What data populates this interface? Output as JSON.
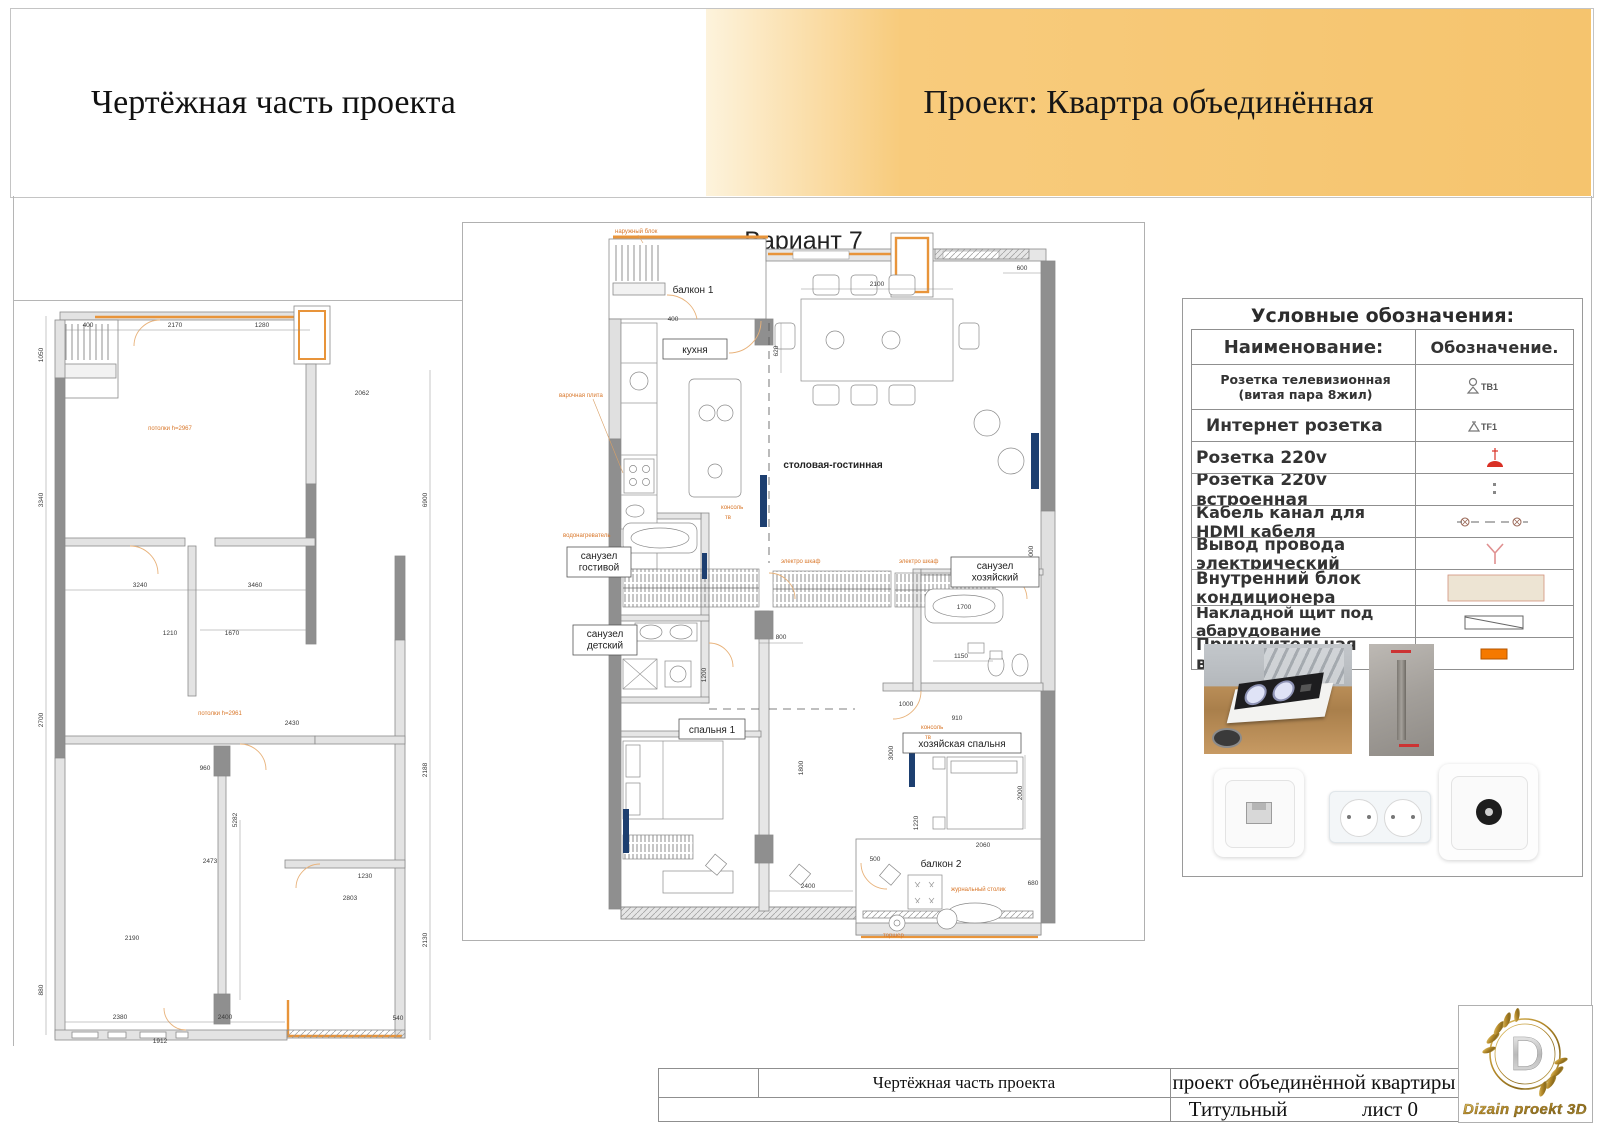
{
  "header": {
    "left_title": "Чертёжная часть проекта",
    "right_title": "Проект: Квартра объединённая"
  },
  "center_plan": {
    "title": "Вариант 7",
    "rooms": {
      "balcony1": "балкон 1",
      "kitchen": "кухня",
      "living": "столовая-гостинная",
      "bath_guest": "санузел\nгостивой",
      "bath_kids": "санузел\nдетский",
      "bath_master": "санузел\nхозяйский",
      "bedroom1": "спальня 1",
      "bedroom_master": "хозяйская спальня",
      "balcony2": "балкон 2"
    },
    "annotations": [
      "наружный блок",
      "варочная плита",
      "водонагреватель",
      "электро шкаф",
      "электро шкаф",
      "консоль",
      "тв",
      "консоль",
      "тв",
      "журнальный столик",
      "торшер"
    ],
    "dims": [
      "2100",
      "600",
      "620",
      "800",
      "400",
      "1200",
      "1000",
      "1020",
      "2400",
      "910",
      "2000",
      "1150",
      "1700",
      "5000",
      "3000",
      "1800",
      "500",
      "1220",
      "2060",
      "680"
    ]
  },
  "left_plan": {
    "ceiling_top": "потолки h=2967",
    "ceiling_bottom": "потолки h=2961",
    "dims": [
      "1050",
      "2170",
      "400",
      "1280",
      "3340",
      "2700",
      "1210",
      "1670",
      "2430",
      "2062",
      "3240",
      "3460",
      "6900",
      "2188",
      "2130",
      "2380",
      "2400",
      "1912",
      "880",
      "1230",
      "2473",
      "2803",
      "5282",
      "960",
      "2190",
      "540"
    ]
  },
  "legend": {
    "title": "Условные обозначения:",
    "col_name": "Наименование:",
    "col_symbol": "Обозначение.",
    "rows": [
      {
        "name": "Розетка телевизионная\n(витая пара 8жил)",
        "tag": "ТВ1"
      },
      {
        "name": "Интернет розетка",
        "tag": "TF1"
      },
      {
        "name": "Розетка 220v"
      },
      {
        "name": "Розетка 220v встроенная"
      },
      {
        "name": "Кабель канал для HDMI кабеля"
      },
      {
        "name": "Вывод провода электрический"
      },
      {
        "name": "Внутренний блок кондиционера"
      },
      {
        "name": "Накладной щит под абарудование"
      },
      {
        "name": "Принудительная вытяжка"
      }
    ]
  },
  "title_block": {
    "part": "Чертёжная часть проекта",
    "project": "проект объединённой квартиры",
    "sheet_type": "Титульный",
    "sheet_no": "лист 0"
  },
  "logo": {
    "letter": "D",
    "caption": "Dizain proekt 3D"
  },
  "colors": {
    "banner_gold": "#f6c878",
    "wall_dark": "#8f8f8f",
    "wall_light": "#e3e3e3",
    "accent_orange": "#e8943a",
    "annotation_orange": "#d9772a",
    "tv_blue": "#1d3f70",
    "symbol_red": "#d93025",
    "vent_orange": "#f57900",
    "ac_beige": "#ede4d3"
  }
}
